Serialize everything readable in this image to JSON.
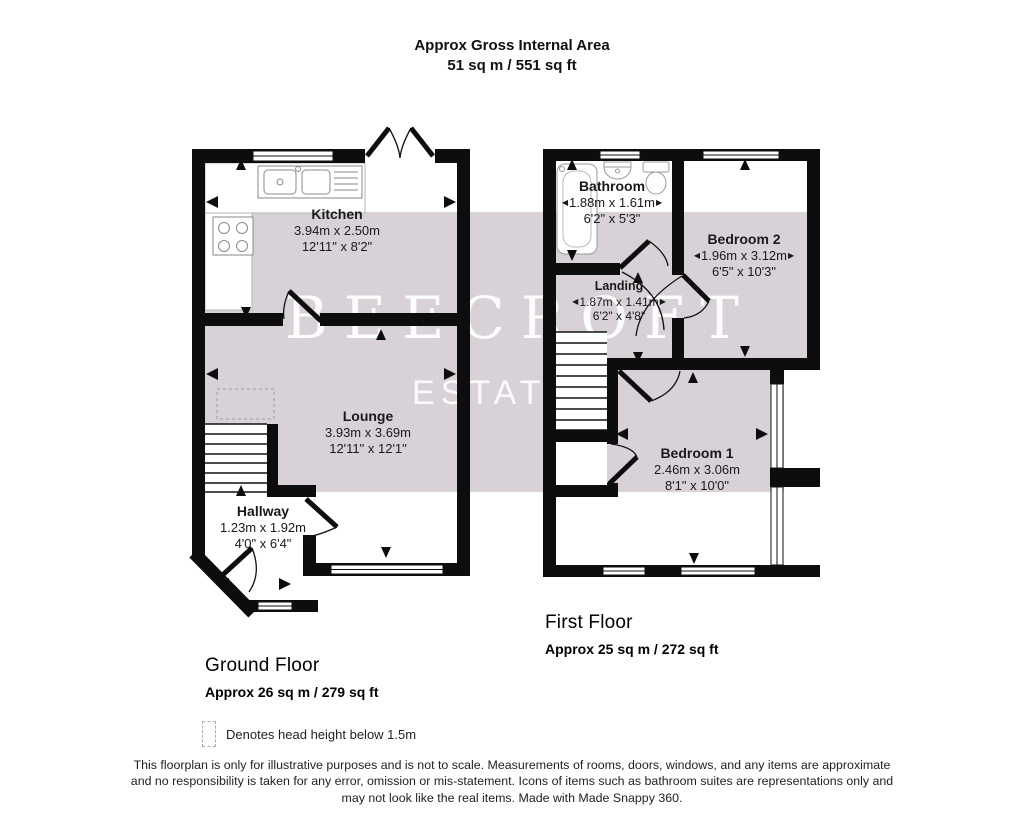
{
  "header": {
    "title": "Approx Gross Internal Area",
    "area": "51 sq m / 551 sq ft"
  },
  "watermark": {
    "brand": "BEECROFT",
    "sub": "ESTATES"
  },
  "glyphs": {
    "arrow_left": "◀",
    "arrow_right": "▶"
  },
  "rooms": {
    "kitchen": {
      "name": "Kitchen",
      "metric": "3.94m x 2.50m",
      "imperial": "12'11\" x 8'2\""
    },
    "lounge": {
      "name": "Lounge",
      "metric": "3.93m x 3.69m",
      "imperial": "12'11\" x 12'1\""
    },
    "hallway": {
      "name": "Hallway",
      "metric": "1.23m x 1.92m",
      "imperial": "4'0\" x 6'4\""
    },
    "bathroom": {
      "name": "Bathroom",
      "metric": "1.88m x 1.61m",
      "imperial": "6'2\" x 5'3\""
    },
    "bedroom2": {
      "name": "Bedroom 2",
      "metric": "1.96m x 3.12m",
      "imperial": "6'5\" x 10'3\""
    },
    "landing": {
      "name": "Landing",
      "metric": "1.87m x 1.41m",
      "imperial": "6'2\" x 4'8\""
    },
    "bedroom1": {
      "name": "Bedroom 1",
      "metric": "2.46m x 3.06m",
      "imperial": "8'1\" x 10'0\""
    }
  },
  "floors": {
    "ground": {
      "label": "Ground Floor",
      "area": "Approx 26 sq m / 279 sq ft"
    },
    "first": {
      "label": "First Floor",
      "area": "Approx 25 sq m / 272 sq ft"
    }
  },
  "legend": {
    "text": "Denotes head height below 1.5m"
  },
  "footer": {
    "lines": [
      "This floorplan is only for illustrative purposes and is not to scale. Measurements of rooms, doors, windows, and any items are approximate",
      "and no responsibility is taken for any error, omission or mis-statement. Icons of items such as bathroom suites are representations only and",
      "may not look like the real items. Made with Made Snappy 360."
    ]
  },
  "colors": {
    "band": "#d8d2d8",
    "wall": "#0d0d0d"
  }
}
